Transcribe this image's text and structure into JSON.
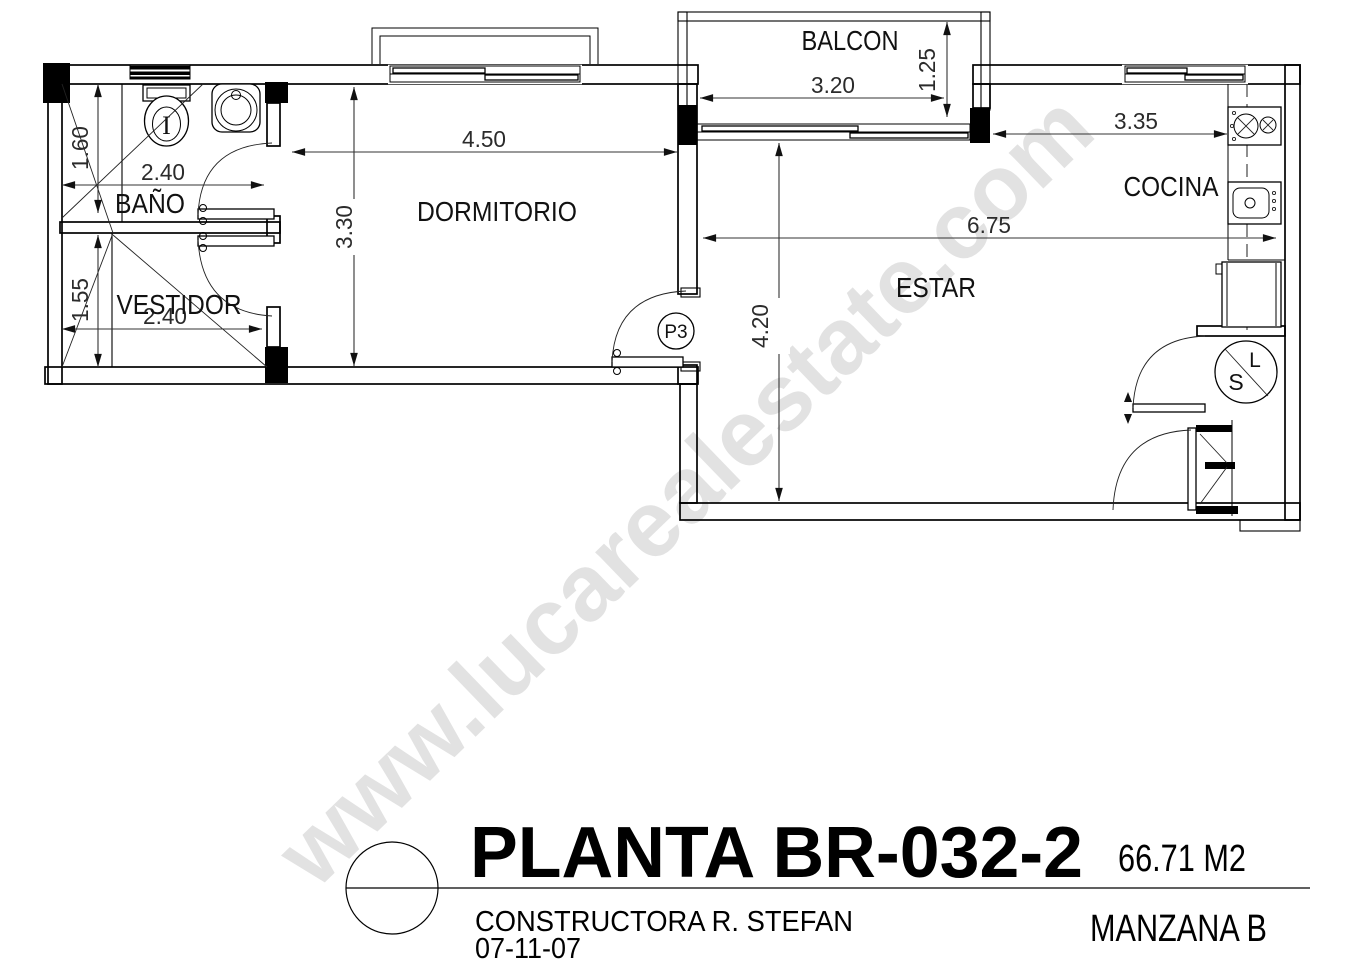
{
  "watermark": {
    "text": "www.lucarealestate.com",
    "color": "#e2e2e2"
  },
  "plan": {
    "rooms": {
      "bano": {
        "label": "BAÑO",
        "width": "2.40",
        "height": "1.60"
      },
      "vestidor": {
        "label": "VESTIDOR",
        "width": "2.40",
        "height": "1.55"
      },
      "dormitorio": {
        "label": "DORMITORIO",
        "width": "4.50",
        "height": "3.30"
      },
      "balcon": {
        "label": "BALCON",
        "width": "3.20",
        "depth": "1.25"
      },
      "cocina": {
        "label": "COCINA",
        "width": "3.35"
      },
      "estar": {
        "label": "ESTAR",
        "width": "6.75",
        "height": "4.20"
      }
    },
    "door_tag": "P3",
    "fixtures": {
      "toilet_mark": "I",
      "laundry_top": "L",
      "laundry_bottom": "S"
    }
  },
  "title_block": {
    "title": "PLANTA BR-032-2",
    "area": "66.71 M2",
    "company": "CONSTRUCTORA R. STEFAN",
    "date": "07-11-07",
    "block": "MANZANA B"
  },
  "line_color": "#000000"
}
